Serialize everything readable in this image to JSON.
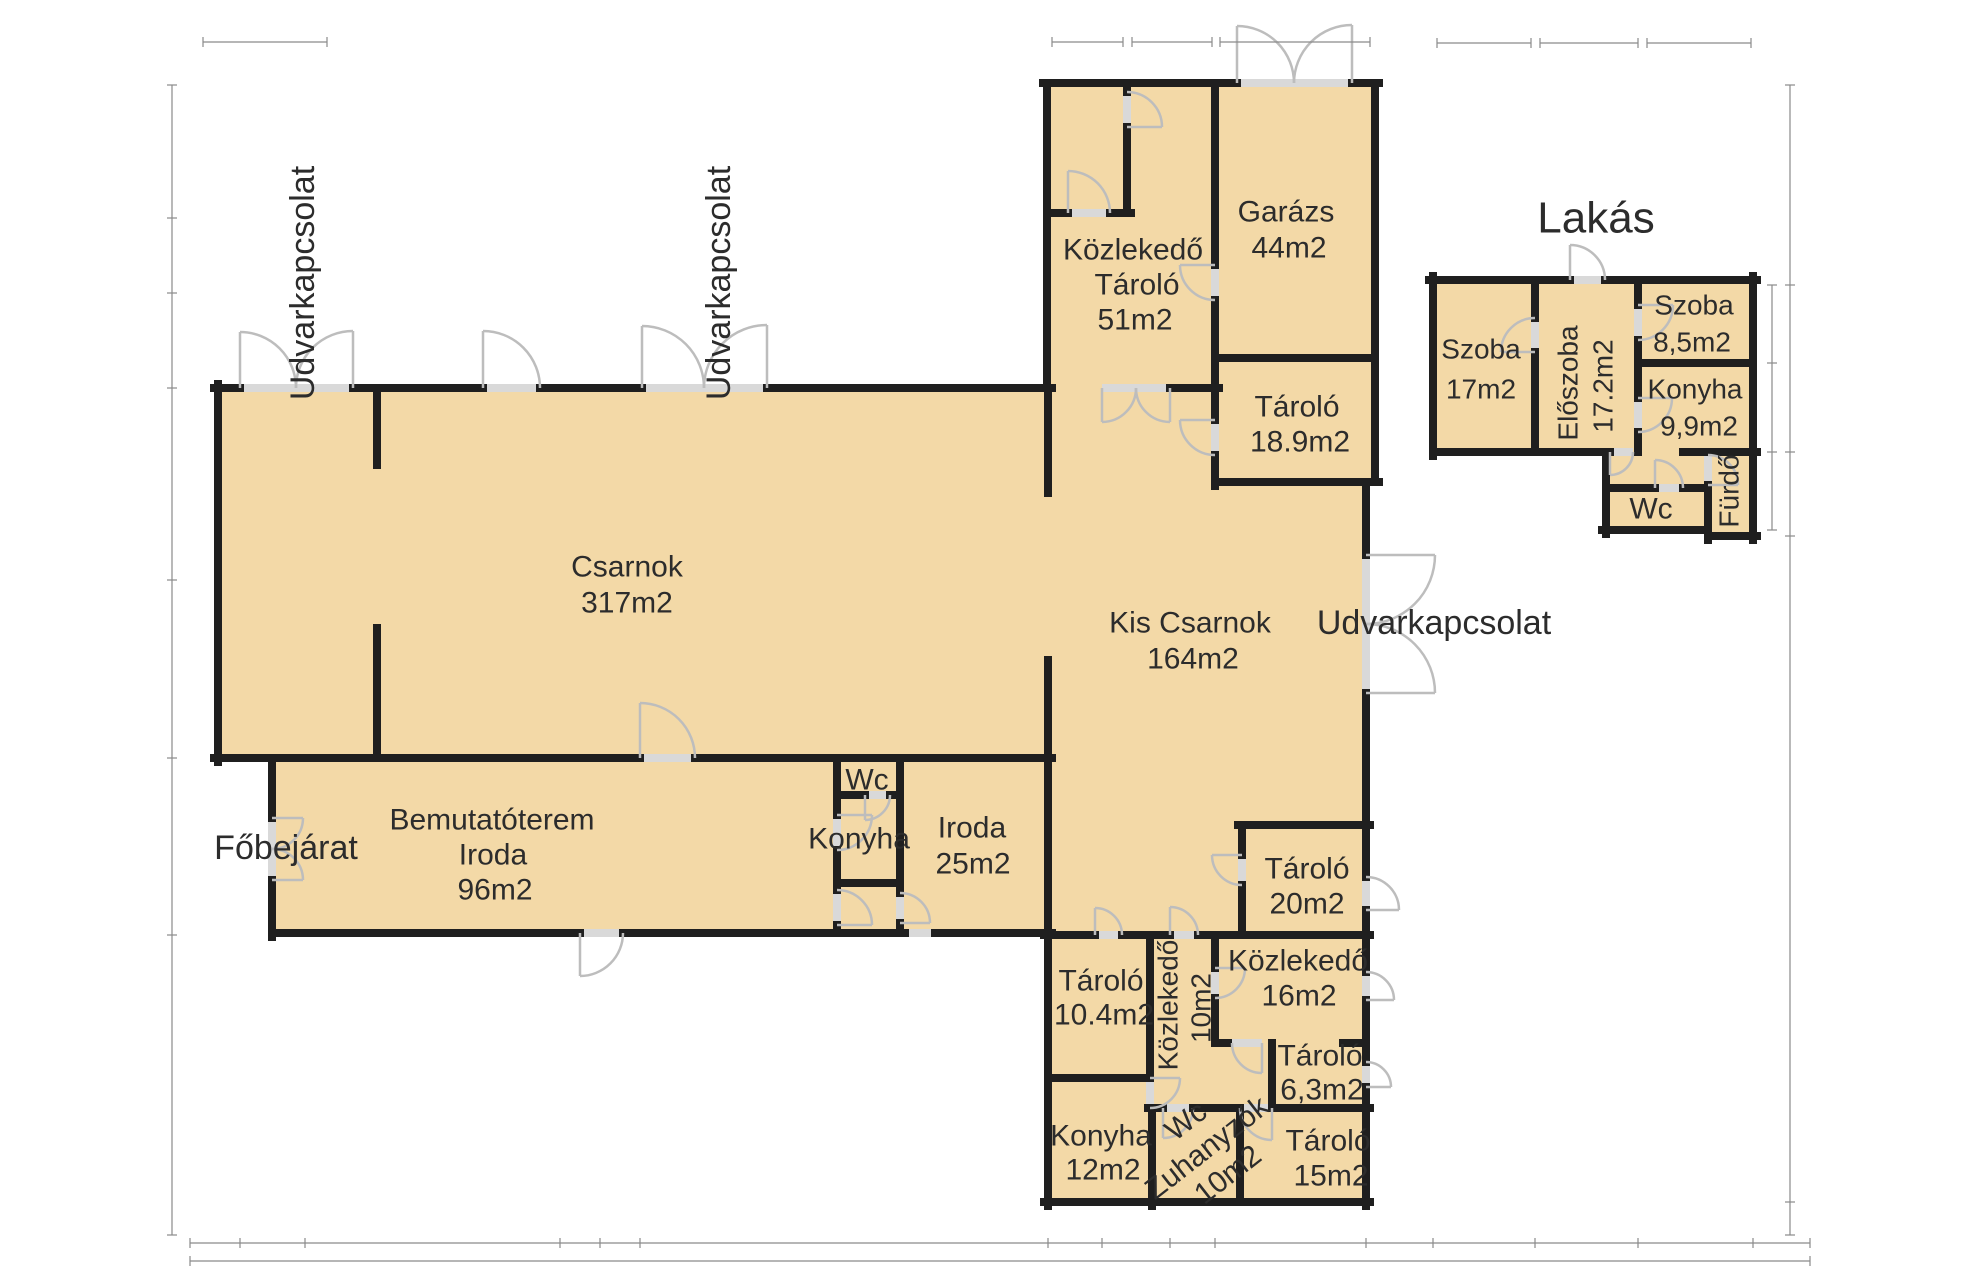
{
  "plan": {
    "title": "Lakás",
    "colors": {
      "room_fill": "#f3d9a7",
      "wall": "#1f1f1f",
      "door_arc": "#bdbdbd",
      "threshold": "#d9d9d9",
      "dimension_line": "#8a8a8a"
    },
    "labels": {
      "fobejarat": "Főbejárat",
      "udvarkapcsolat_left": "Udvarkapcsolat",
      "udvarkapcsolat_mid": "Udvarkapcsolat",
      "udvarkapcsolat_right": "Udvarkapcsolat"
    },
    "rooms": {
      "csarnok": {
        "name": "Csarnok",
        "area": "317m2"
      },
      "kis_csarnok": {
        "name": "Kis Csarnok",
        "area": "164m2"
      },
      "kozlekedo_tarolo": {
        "name": "Közlekedő",
        "name2": "Tároló",
        "area": "51m2"
      },
      "garazs": {
        "name": "Garázs",
        "area": "44m2"
      },
      "tarolo_18_9": {
        "name": "Tároló",
        "area": "18.9m2"
      },
      "bemutatoterem": {
        "name": "Bemutatóterem",
        "name2": "Iroda",
        "area": "96m2"
      },
      "wc_uzem": {
        "name": "Wc"
      },
      "konyha_uzem": {
        "name": "Konyha"
      },
      "iroda_25": {
        "name": "Iroda",
        "area": "25m2"
      },
      "tarolo_20": {
        "name": "Tároló",
        "area": "20m2"
      },
      "tarolo_10_4": {
        "name": "Tároló",
        "area": "10.4m2"
      },
      "kozlekedo_10": {
        "name": "Közlekedő",
        "area": "10m2"
      },
      "kozlekedo_16": {
        "name": "Közlekedő",
        "area": "16m2"
      },
      "tarolo_6_3": {
        "name": "Tároló",
        "area": "6,3m2"
      },
      "konyha_12": {
        "name": "Konyha",
        "area": "12m2"
      },
      "wc_zuhanyzok": {
        "name": "Wc",
        "name2": "Zuhanyzók",
        "area": "10m2"
      },
      "tarolo_15": {
        "name": "Tároló",
        "area": "15m2"
      },
      "szoba_17": {
        "name": "Szoba",
        "area": "17m2"
      },
      "eloszoba": {
        "name": "Előszoba",
        "area": "17.2m2"
      },
      "szoba_8_5": {
        "name": "Szoba",
        "area": "8,5m2"
      },
      "konyha_9_9": {
        "name": "Konyha",
        "area": "9,9m2"
      },
      "wc_lakas": {
        "name": "Wc"
      },
      "furdo": {
        "name": "Fürdő"
      }
    }
  }
}
